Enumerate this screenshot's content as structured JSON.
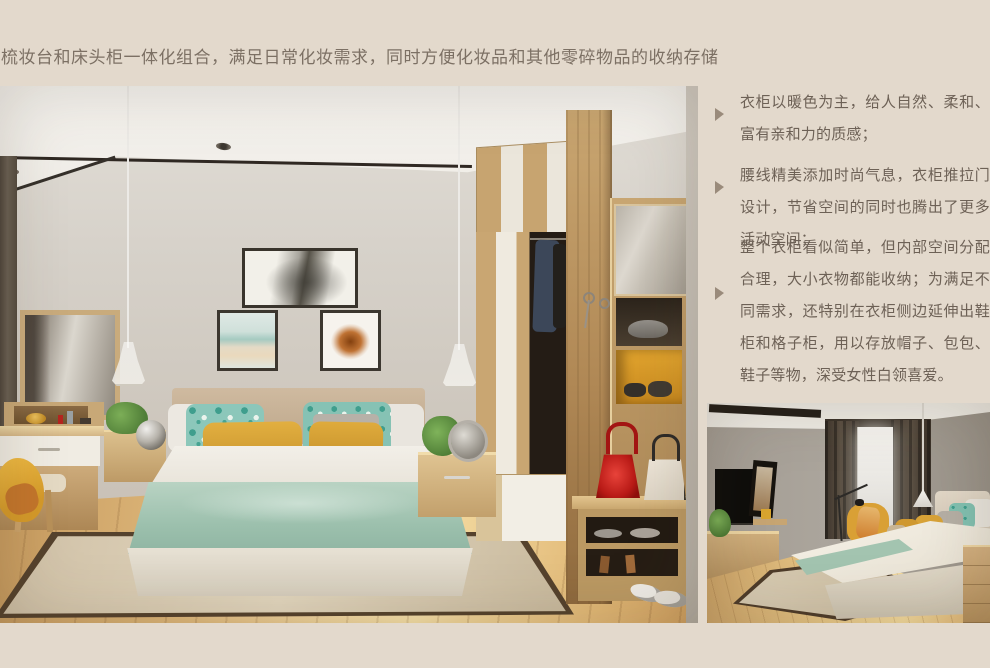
{
  "page": {
    "background_color": "#e3d9cc",
    "headline": "梳妆台和床头柜一体化组合，满足日常化妆需求，同时方便化妆品和其他零碎物品的收纳存储",
    "headline_color": "#7c7064"
  },
  "features": {
    "bullet_icon": "right-triangle-icon",
    "bullet_color": "#9a8b7b",
    "text_color": "#6d6156",
    "items": [
      {
        "text": "衣柜以暖色为主，给人自然、柔和、富有亲和力的质感；"
      },
      {
        "text": "腰线精美添加时尚气息，衣柜推拉门设计，节省空间的同时也腾出了更多活动空间；"
      },
      {
        "text": "整个衣柜看似简单，但内部空间分配合理，大小衣物都能收纳；为满足不同需求，还特别在衣柜侧边延伸出鞋柜和格子柜，用以存放帽子、包包、鞋子等物，深受女性白领喜爱。"
      }
    ]
  },
  "photos": {
    "main_accent_colors": {
      "wood": "#c9a673",
      "mustard_pillow": "#d9a438",
      "teal_pillow": "#8cc7ba",
      "sage_blanket": "#a6c8b7",
      "red_handbag": "#c21f1f",
      "orange_cubby": "#e0a42e"
    },
    "secondary_accent_colors": {
      "curtain": "#4a4036",
      "mustard_pillow": "#d8a237",
      "sage_blanket": "#a3c4b0"
    }
  }
}
